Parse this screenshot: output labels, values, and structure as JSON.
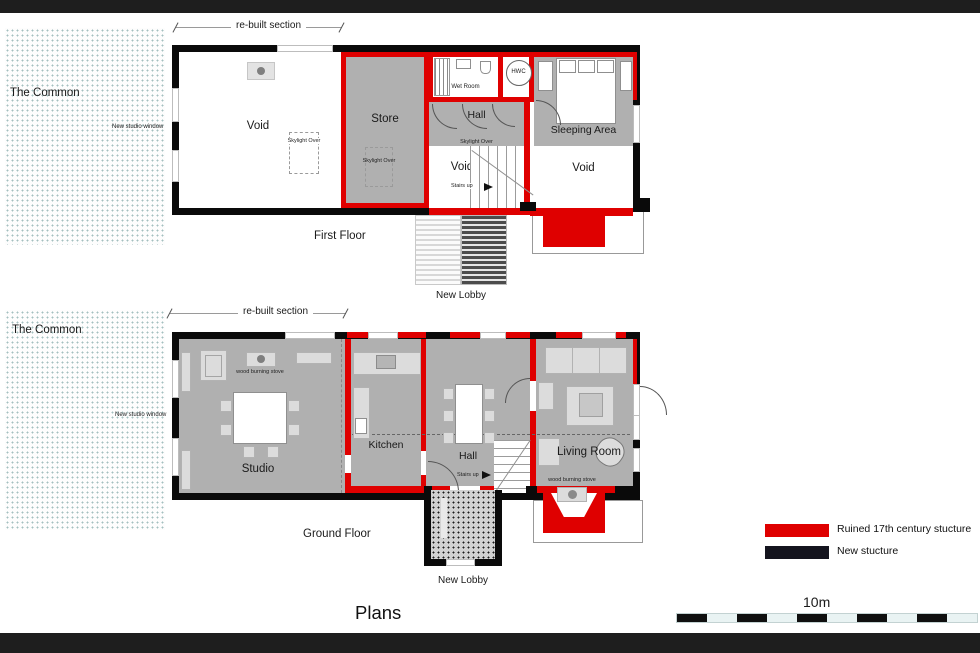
{
  "title": "Plans",
  "colors": {
    "ruined": "#df0000",
    "new_structure": "#14141e",
    "wall": "#0a0a0a",
    "room_gray": "#b0b0b0",
    "furniture": "#dcdcdc",
    "frame_bar": "#1e1e1e",
    "scale_light": "#e9f3f3"
  },
  "labels": {
    "common": "The Common",
    "rebuilt_section": "re-built section",
    "new_studio_window": "New studio window",
    "skylight_over": "Skylight Over",
    "stairs_up": "Stairs up",
    "wood_burning_stove": "wood burning stove",
    "new_lobby": "New Lobby"
  },
  "first_floor": {
    "title": "First Floor",
    "rooms": {
      "void": "Void",
      "store": "Store",
      "wet_room": "Wet Room",
      "hwc": "HWC",
      "hall": "Hall",
      "sleeping_area": "Sleeping Area"
    }
  },
  "ground_floor": {
    "title": "Ground Floor",
    "rooms": {
      "studio": "Studio",
      "kitchen": "Kitchen",
      "hall": "Hall",
      "living_room": "Living Room"
    }
  },
  "legend": {
    "items": [
      {
        "label": "Ruined 17th century stucture",
        "color": "#df0000"
      },
      {
        "label": "New stucture",
        "color": "#14141e"
      }
    ]
  },
  "scale_bar": {
    "label": "10m",
    "segments": 10
  }
}
